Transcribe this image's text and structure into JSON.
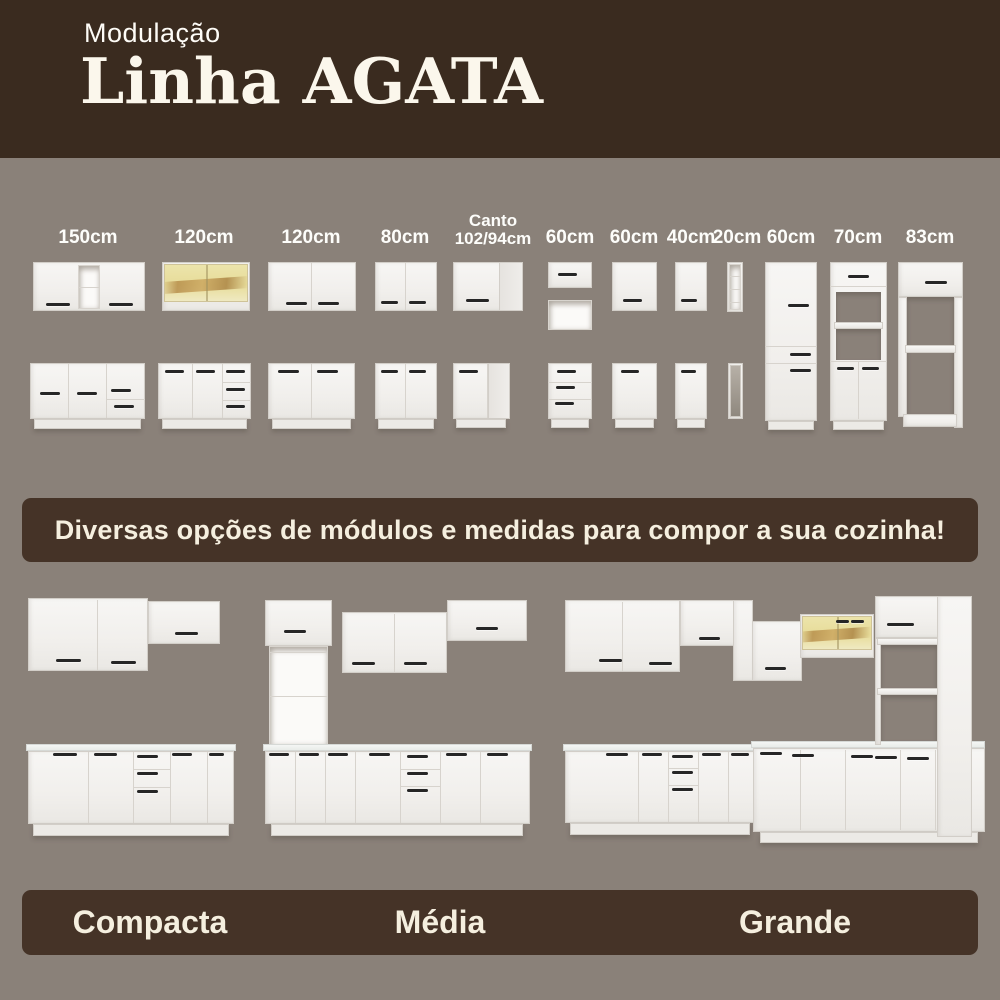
{
  "header": {
    "kicker": "Modulação",
    "title": "Linha AGATA"
  },
  "modules": {
    "items": [
      {
        "label": "150cm"
      },
      {
        "label": "120cm"
      },
      {
        "label": "120cm"
      },
      {
        "label": "80cm"
      },
      {
        "label": "Canto 102/94cm",
        "line1": "Canto",
        "line2": "102/94cm"
      },
      {
        "label": "60cm"
      },
      {
        "label": "60cm"
      },
      {
        "label": "40cm"
      },
      {
        "label": "20cm"
      },
      {
        "label": "60cm"
      },
      {
        "label": "70cm"
      },
      {
        "label": "83cm"
      }
    ]
  },
  "banner": {
    "text": "Diversas opções de módulos e medidas para compor a sua cozinha!"
  },
  "kitchens": [
    {
      "name": "Compacta"
    },
    {
      "name": "Média"
    },
    {
      "name": "Grande"
    }
  ],
  "colors": {
    "background": "#8a8179",
    "header_bg": "#3a2b1f",
    "bar_bg": "#453327",
    "text_cream": "#f5efdf",
    "cabinet_white": "#f4f2ef",
    "handle_dark": "#262626",
    "glass_yellow": "#e8df9d"
  }
}
